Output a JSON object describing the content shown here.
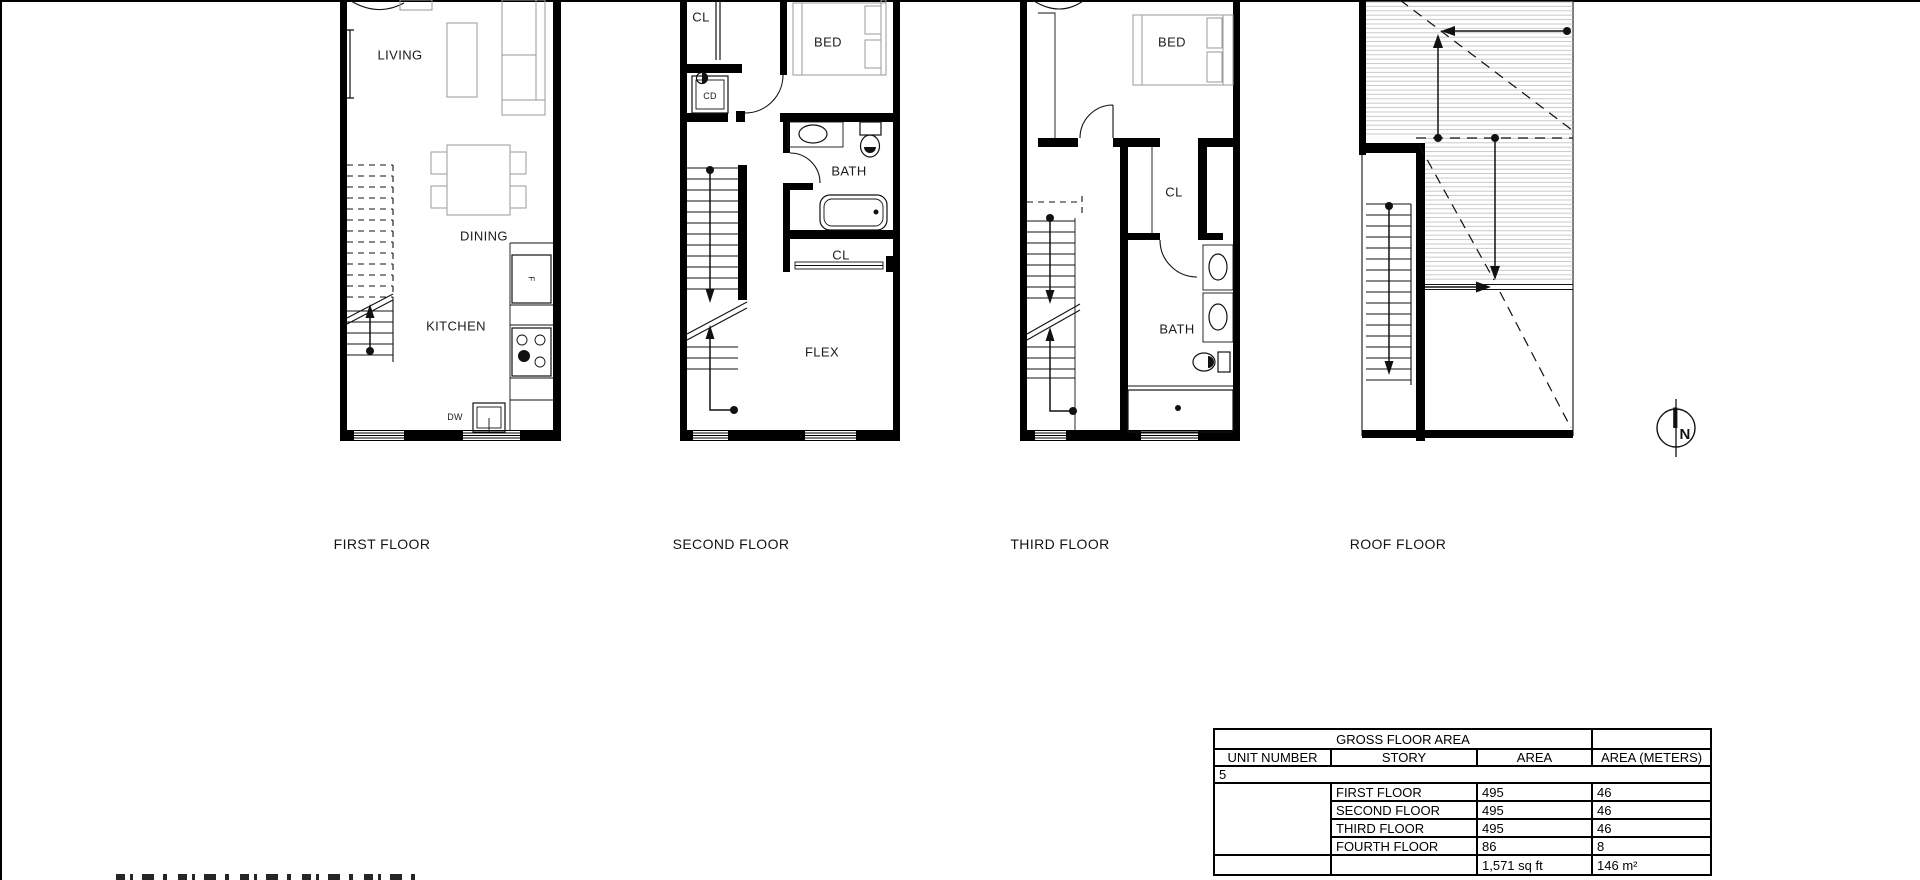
{
  "sheet": {
    "background": "#ffffff",
    "line_color": "#000000",
    "hatch_color": "#bcbcbc"
  },
  "plans": {
    "first": {
      "title": "FIRST FLOOR",
      "labels": {
        "living": "LIVING",
        "dining": "DINING",
        "kitchen": "KITCHEN",
        "dishwasher": "DW",
        "fridge": "F"
      }
    },
    "second": {
      "title": "SECOND FLOOR",
      "labels": {
        "closet_top": "CL",
        "closet_dryer": "CD",
        "bed": "BED",
        "bath": "BATH",
        "closet_mid": "CL",
        "flex": "FLEX"
      }
    },
    "third": {
      "title": "THIRD FLOOR",
      "labels": {
        "bed": "BED",
        "closet": "CL",
        "bath": "BATH"
      }
    },
    "roof": {
      "title": "ROOF FLOOR"
    }
  },
  "north_arrow": {
    "label": "N"
  },
  "area_table": {
    "title": "GROSS FLOOR AREA",
    "columns": [
      "UNIT NUMBER",
      "STORY",
      "AREA",
      "AREA (METERS)"
    ],
    "unit_number": "5",
    "rows": [
      {
        "story": "FIRST FLOOR",
        "area": "495",
        "area_meters": "46"
      },
      {
        "story": "SECOND FLOOR",
        "area": "495",
        "area_meters": "46"
      },
      {
        "story": "THIRD FLOOR",
        "area": "495",
        "area_meters": "46"
      },
      {
        "story": "FOURTH FLOOR",
        "area": "86",
        "area_meters": "8"
      }
    ],
    "total": {
      "area": "1,571 sq ft",
      "area_meters": "146 m²"
    }
  }
}
